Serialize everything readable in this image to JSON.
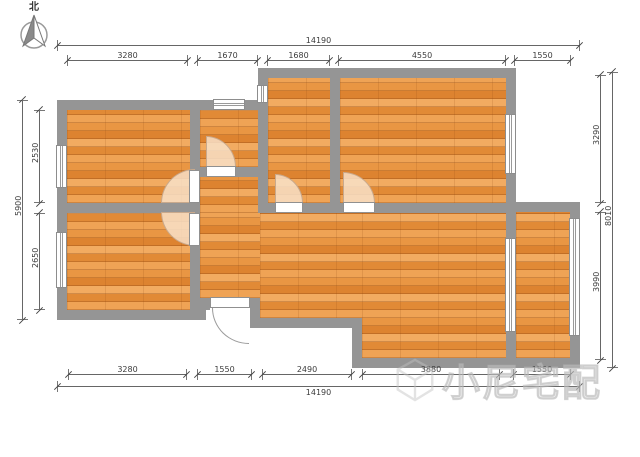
{
  "compass": {
    "label": "北"
  },
  "watermark": {
    "brand": "小尼宅配"
  },
  "dimensions": {
    "top": {
      "overall": "14190",
      "segments": [
        "3280",
        "1670",
        "1680",
        "4550",
        "1550"
      ]
    },
    "bottom": {
      "overall": "14190",
      "segments": [
        "3280",
        "1550",
        "2490",
        "3880",
        "1550"
      ]
    },
    "left": {
      "overall": "5900",
      "segments": [
        "2530",
        "2650"
      ]
    },
    "right": {
      "overall": "8010",
      "segments": [
        "3290",
        "3990"
      ]
    }
  },
  "colors": {
    "wall": "#959595",
    "floor_base": "#e68d3c",
    "dimension_text": "#3c3c3c",
    "door_swing_fill": "#f8e0c8"
  }
}
